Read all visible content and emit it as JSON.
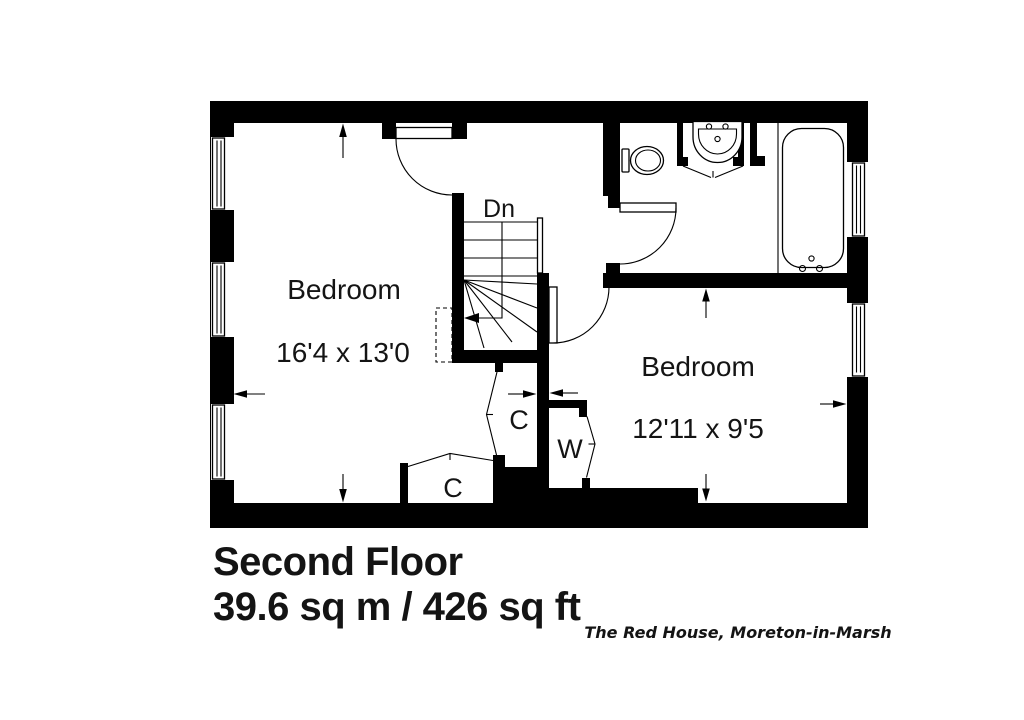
{
  "floor_plan": {
    "rooms": {
      "bedroom1": {
        "label": "Bedroom",
        "dimensions": "16'4 x 13'0"
      },
      "bedroom2": {
        "label": "Bedroom",
        "dimensions": "12'11 x 9'5"
      }
    },
    "stairs": {
      "direction": "Dn"
    },
    "closets": {
      "closet_hall": "C",
      "closet_bottom": "C",
      "wardrobe": "W"
    }
  },
  "title_block": {
    "floor_name": "Second Floor",
    "area": "39.6 sq m / 426 sq ft"
  },
  "property_label": "The Red House, Moreton-in-Marsh",
  "colors": {
    "walls": "#000000",
    "text": "#141414",
    "background": "#ffffff"
  }
}
